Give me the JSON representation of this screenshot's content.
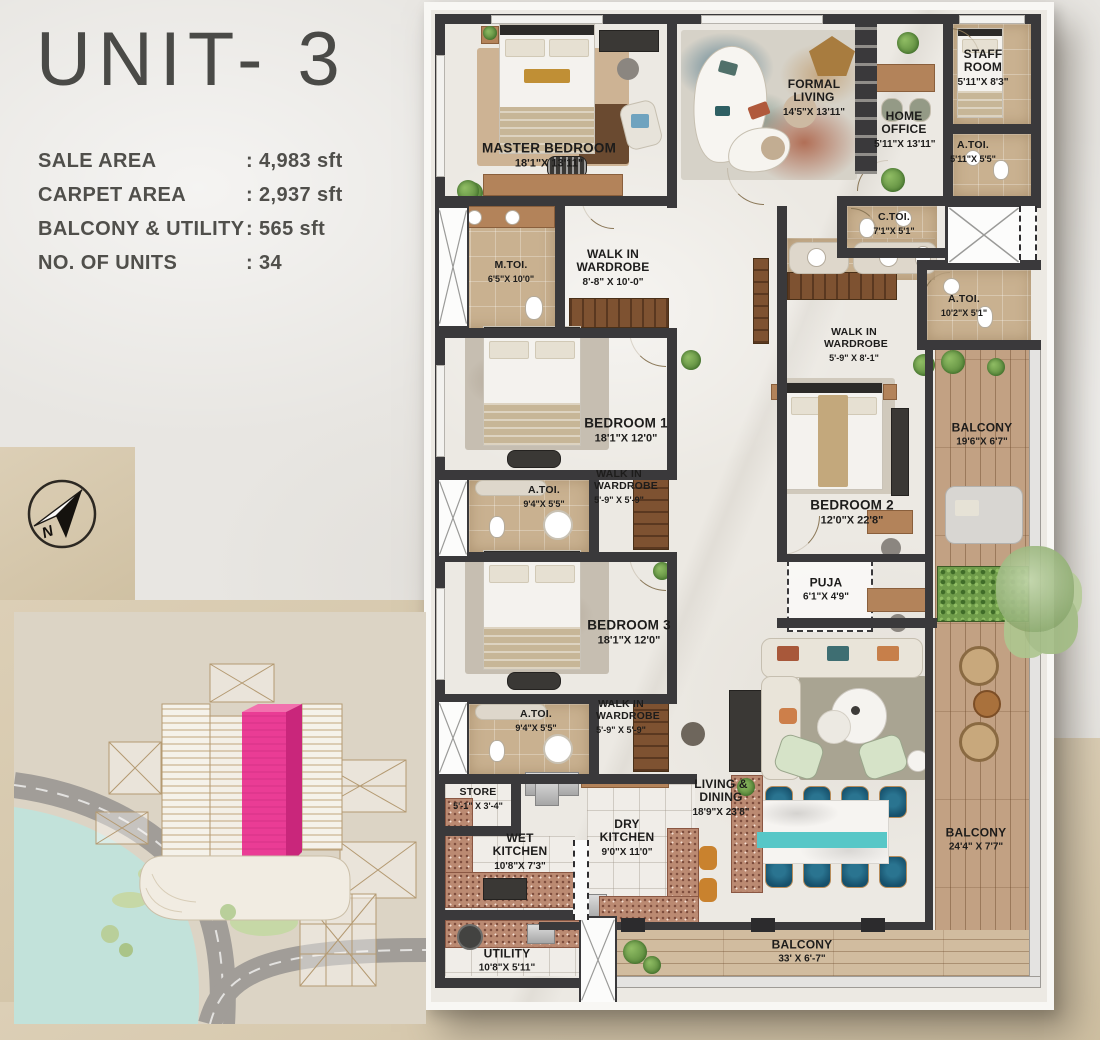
{
  "panel": {
    "title": "UNIT- 3",
    "stats": [
      {
        "label": "SALE AREA",
        "value": ": 4,983 sft"
      },
      {
        "label": "CARPET AREA",
        "value": ": 2,937 sft"
      },
      {
        "label": "BALCONY & UTILITY",
        "value": ": 565 sft"
      },
      {
        "label": "NO. OF UNITS",
        "value": ": 34"
      }
    ]
  },
  "compass": {
    "letter": "N"
  },
  "floor_plan": {
    "rooms": [
      {
        "id": "master-bedroom",
        "name": "MASTER BEDROOM",
        "dims": "18'1\"X 13'11\""
      },
      {
        "id": "formal-living",
        "name": "FORMAL LIVING",
        "dims": "14'5\"X 13'11\""
      },
      {
        "id": "home-office",
        "name": "HOME OFFICE",
        "dims": "5'11\"X 13'11\""
      },
      {
        "id": "staff-room",
        "name": "STAFF ROOM",
        "dims": "5'11\"X 8'3\""
      },
      {
        "id": "a-toi-staff",
        "name": "A.TOI.",
        "dims": "5'11\"X 5'5\""
      },
      {
        "id": "c-toi",
        "name": "C.TOI.",
        "dims": "7'1\"X 5'1\""
      },
      {
        "id": "m-toi",
        "name": "M.TOI.",
        "dims": "6'5\"X 10'0\""
      },
      {
        "id": "wiw-master",
        "name": "WALK IN WARDROBE",
        "dims": "8'-8\" X 10'-0\""
      },
      {
        "id": "a-toi-right",
        "name": "A.TOI.",
        "dims": "10'2\"X 5'1\""
      },
      {
        "id": "wiw-bedroom2",
        "name": "WALK IN WARDROBE",
        "dims": "5'-9\" X 8'-1\""
      },
      {
        "id": "bedroom-1",
        "name": "BEDROOM 1",
        "dims": "18'1\"X 12'0\""
      },
      {
        "id": "a-toi-bedroom1",
        "name": "A.TOI.",
        "dims": "9'4\"X 5'5\""
      },
      {
        "id": "wiw-bedroom1",
        "name": "WALK IN WARDROBE",
        "dims": "5'-9\" X 5'-9\""
      },
      {
        "id": "balcony-right",
        "name": "BALCONY",
        "dims": "19'6\"X 6'7\""
      },
      {
        "id": "bedroom-2",
        "name": "BEDROOM 2",
        "dims": "12'0\"X 22'8\""
      },
      {
        "id": "puja",
        "name": "PUJA",
        "dims": "6'1\"X 4'9\""
      },
      {
        "id": "bedroom-3",
        "name": "BEDROOM 3",
        "dims": "18'1\"X 12'0\""
      },
      {
        "id": "a-toi-bedroom3",
        "name": "A.TOI.",
        "dims": "9'4\"X 5'5\""
      },
      {
        "id": "wiw-bedroom3",
        "name": "WALK IN WARDROBE",
        "dims": "5'-9\" X 5'-9\""
      },
      {
        "id": "store",
        "name": "STORE",
        "dims": "5'-1\" X 3'-4\""
      },
      {
        "id": "wet-kitchen",
        "name": "WET KITCHEN",
        "dims": "10'8\"X 7'3\""
      },
      {
        "id": "dry-kitchen",
        "name": "DRY KITCHEN",
        "dims": "9'0\"X 11'0\""
      },
      {
        "id": "living-dining",
        "name": "LIVING & DINING",
        "dims": "18'9\"X 23'8\""
      },
      {
        "id": "utility",
        "name": "UTILITY",
        "dims": "10'8\"X 5'11\""
      },
      {
        "id": "balcony-lower-right",
        "name": "BALCONY",
        "dims": "24'4\" X 7'7\""
      },
      {
        "id": "balcony-bottom",
        "name": "BALCONY",
        "dims": "33' X 6'-7\""
      }
    ]
  },
  "colors": {
    "accent_pink": "#ea3c95",
    "wall": "#3a393b",
    "wood_deck": "#c2a183",
    "teal_accent": "#57c7c7",
    "water": "#c2e2da",
    "paper_beige": "#d6c8ac",
    "toilet_tan": "#c9b190"
  }
}
